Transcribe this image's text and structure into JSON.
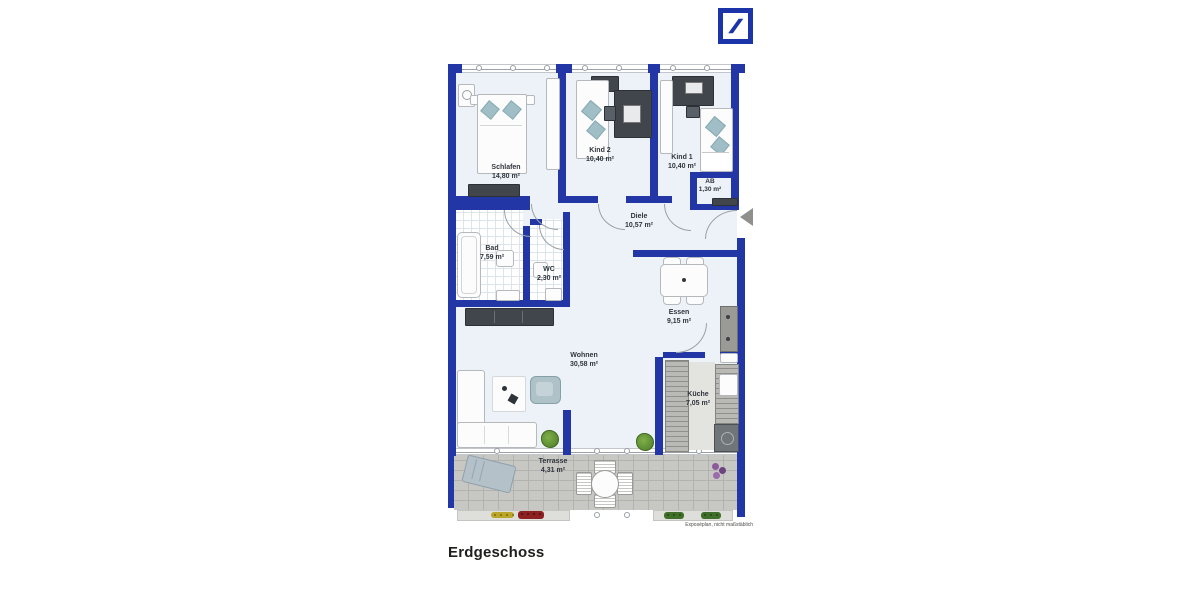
{
  "header": {
    "logo": {
      "label": "Deutsche Bank logo",
      "color": "#1B34A8"
    }
  },
  "plan": {
    "rooms": [
      {
        "name": "Schlafen",
        "area": "14,80 m²"
      },
      {
        "name": "Kind 2",
        "area": "10,40 m²"
      },
      {
        "name": "Kind 1",
        "area": "10,40 m²"
      },
      {
        "name": "AB",
        "area": "1,30 m²"
      },
      {
        "name": "Diele",
        "area": "10,57 m²"
      },
      {
        "name": "Bad",
        "area": "7,59 m²"
      },
      {
        "name": "WC",
        "area": "2,30 m²"
      },
      {
        "name": "Essen",
        "area": "9,15 m²"
      },
      {
        "name": "Wohnen",
        "area": "30,58 m²"
      },
      {
        "name": "Küche",
        "area": "7,05 m²"
      },
      {
        "name": "Terrasse",
        "area": "4,31 m²"
      }
    ],
    "footnote": "Exposéplan, nicht maßstäblich"
  },
  "footer": {
    "floor_label": "Erdgeschoss"
  },
  "colors": {
    "wall": "#2236A6",
    "floor": "#ECF2F8",
    "terrace": "#C7C7C4",
    "logo_blue": "#1B34A8"
  }
}
